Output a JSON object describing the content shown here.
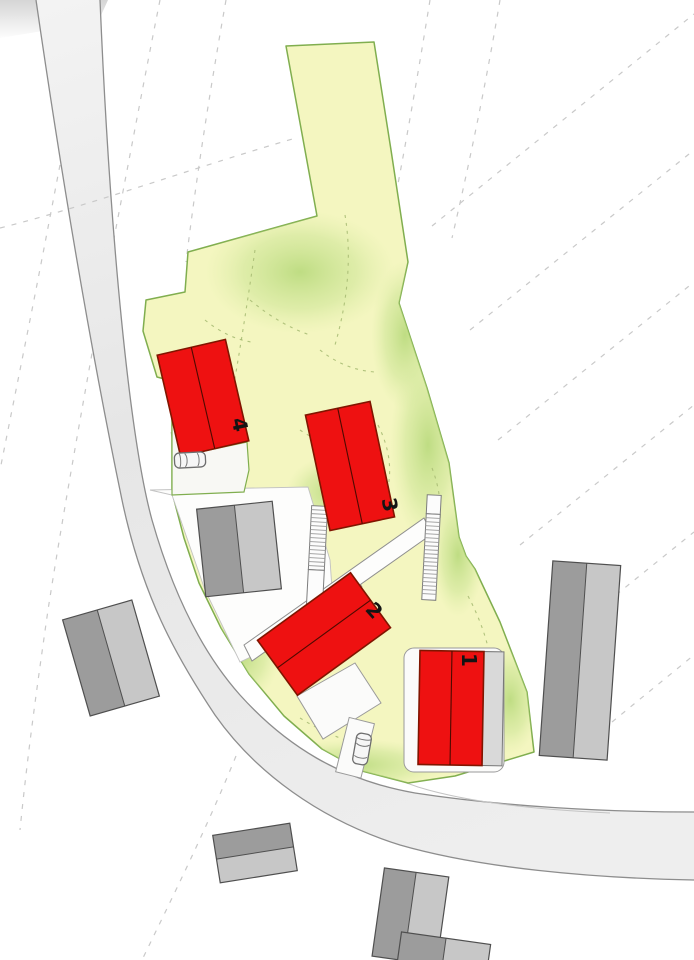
{
  "title": "site-plan",
  "labels": {
    "building_1": "1",
    "building_2": "2",
    "building_3": "3",
    "building_4": "4"
  },
  "colors": {
    "parcel_fill": "#f4f6c0",
    "parcel_stroke": "#80ae4f",
    "slope_green": "#b5d878",
    "new_fill": "#ee1111",
    "new_stroke": "#801500",
    "ridge": "#4d0a00",
    "exist_dark": "#9c9c9c",
    "exist_light": "#c7c7c7",
    "exist_stroke": "#4f4f4f",
    "road_edge": "#8d8d8d",
    "curb": "#c4c4c4",
    "contour": "#c9c9c9",
    "slope_tick": "#a9bd74",
    "label": "#141414",
    "pad_stroke": "#9a9a9a",
    "zone_stroke": "#c2c2c2"
  }
}
